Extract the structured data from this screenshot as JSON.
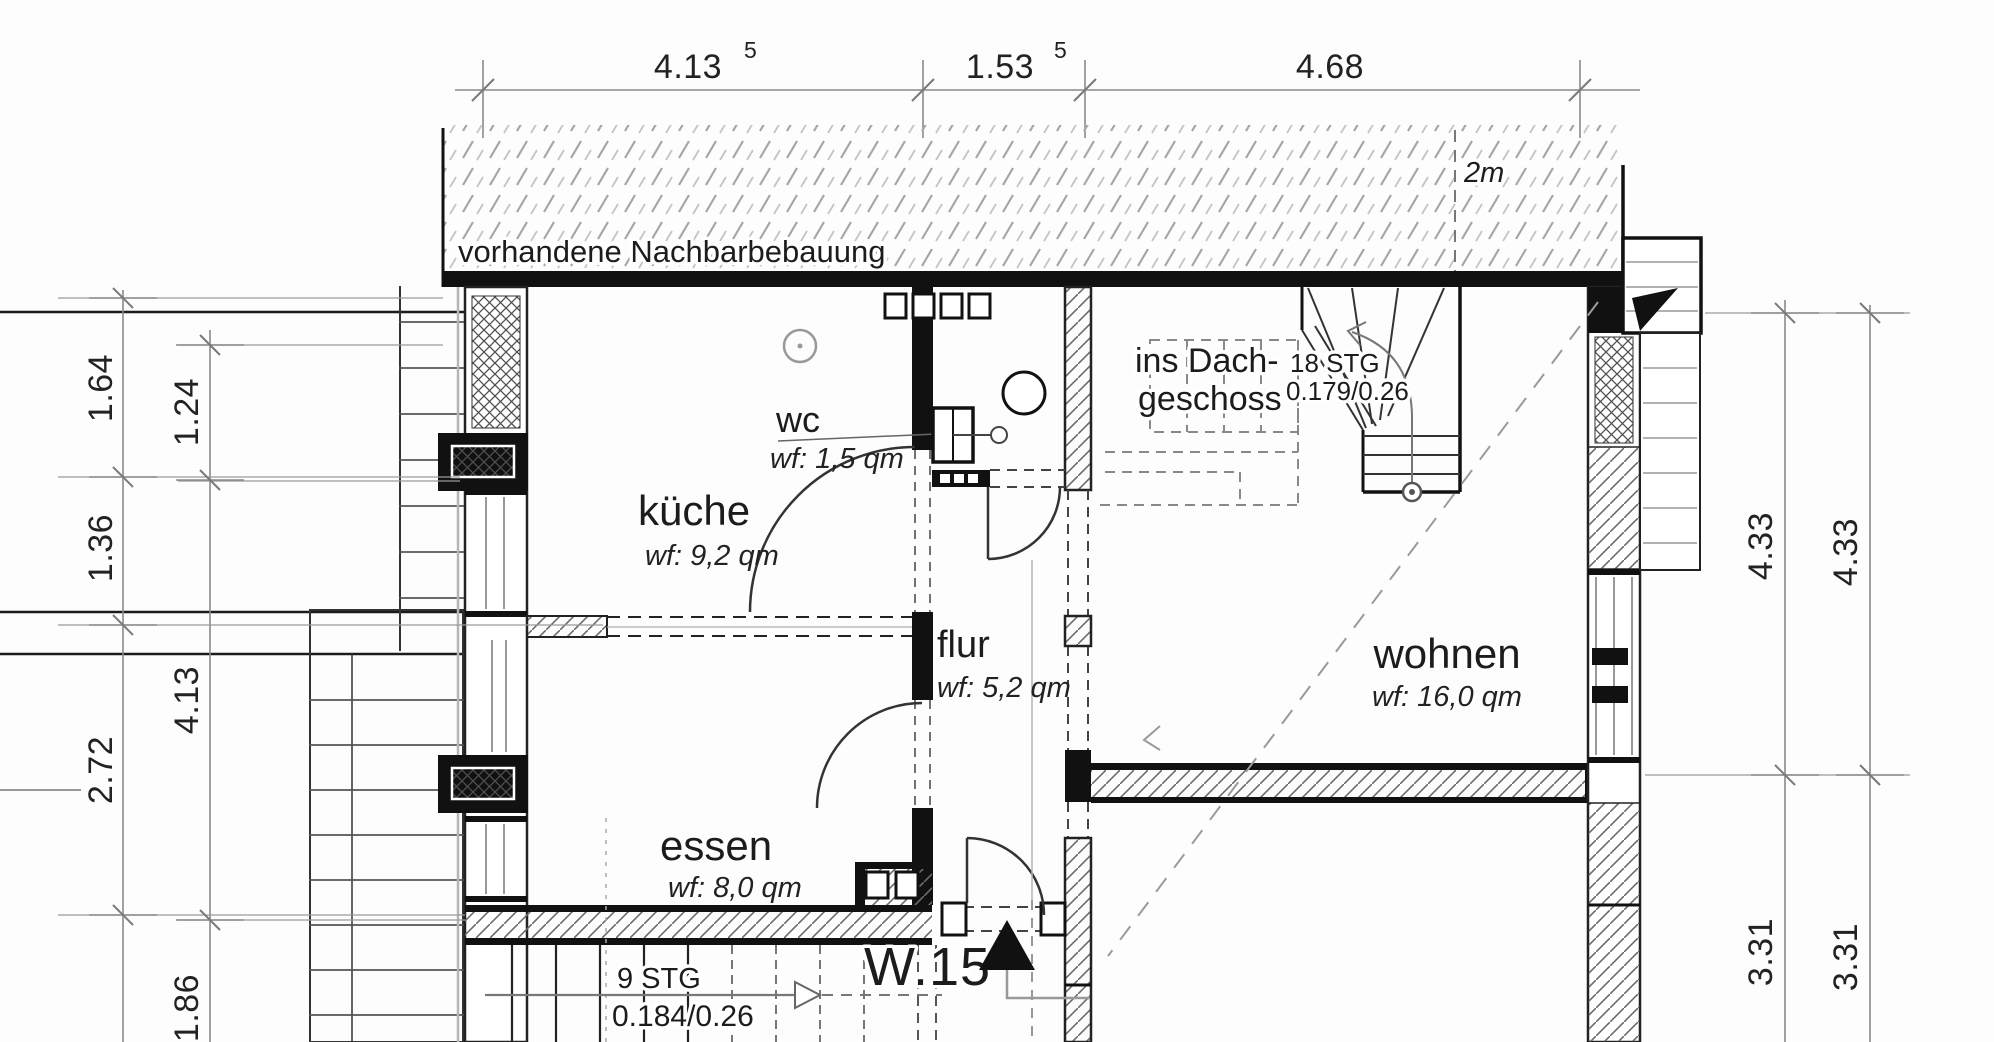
{
  "plan": {
    "neighbor_note": "vorhandene Nachbarbebauung",
    "distance_label": "2m",
    "unit_label": "W.15",
    "rooms": {
      "wc": {
        "name": "wc",
        "area": "wf: 1,5 qm"
      },
      "kueche": {
        "name": "küche",
        "area": "wf: 9,2 qm"
      },
      "flur": {
        "name": "flur",
        "area": "wf: 5,2 qm"
      },
      "essen": {
        "name": "essen",
        "area": "wf: 8,0 qm"
      },
      "wohnen": {
        "name": "wohnen",
        "area": "wf: 16,0 qm"
      }
    },
    "stairs": {
      "attic": {
        "dest1": "ins Dach-",
        "dest2": "geschoss",
        "steps": "18 STG",
        "step_dim": "0.179/0.26"
      },
      "lower": {
        "steps": "9 STG",
        "step_dim": "0.184/0.26"
      }
    },
    "dims": {
      "top": [
        {
          "v": "4.13",
          "sup": "5"
        },
        {
          "v": "1.53",
          "sup": "5"
        },
        {
          "v": "4.68",
          "sup": ""
        }
      ],
      "left_inner": [
        "1.64",
        "1.36",
        "2.72",
        "7"
      ],
      "left_outer": [
        "1.24",
        "4.13",
        "1.86"
      ],
      "right_inner": [
        "4.33",
        "3.31"
      ],
      "right_outer": [
        "4.33",
        "3.31"
      ]
    }
  }
}
